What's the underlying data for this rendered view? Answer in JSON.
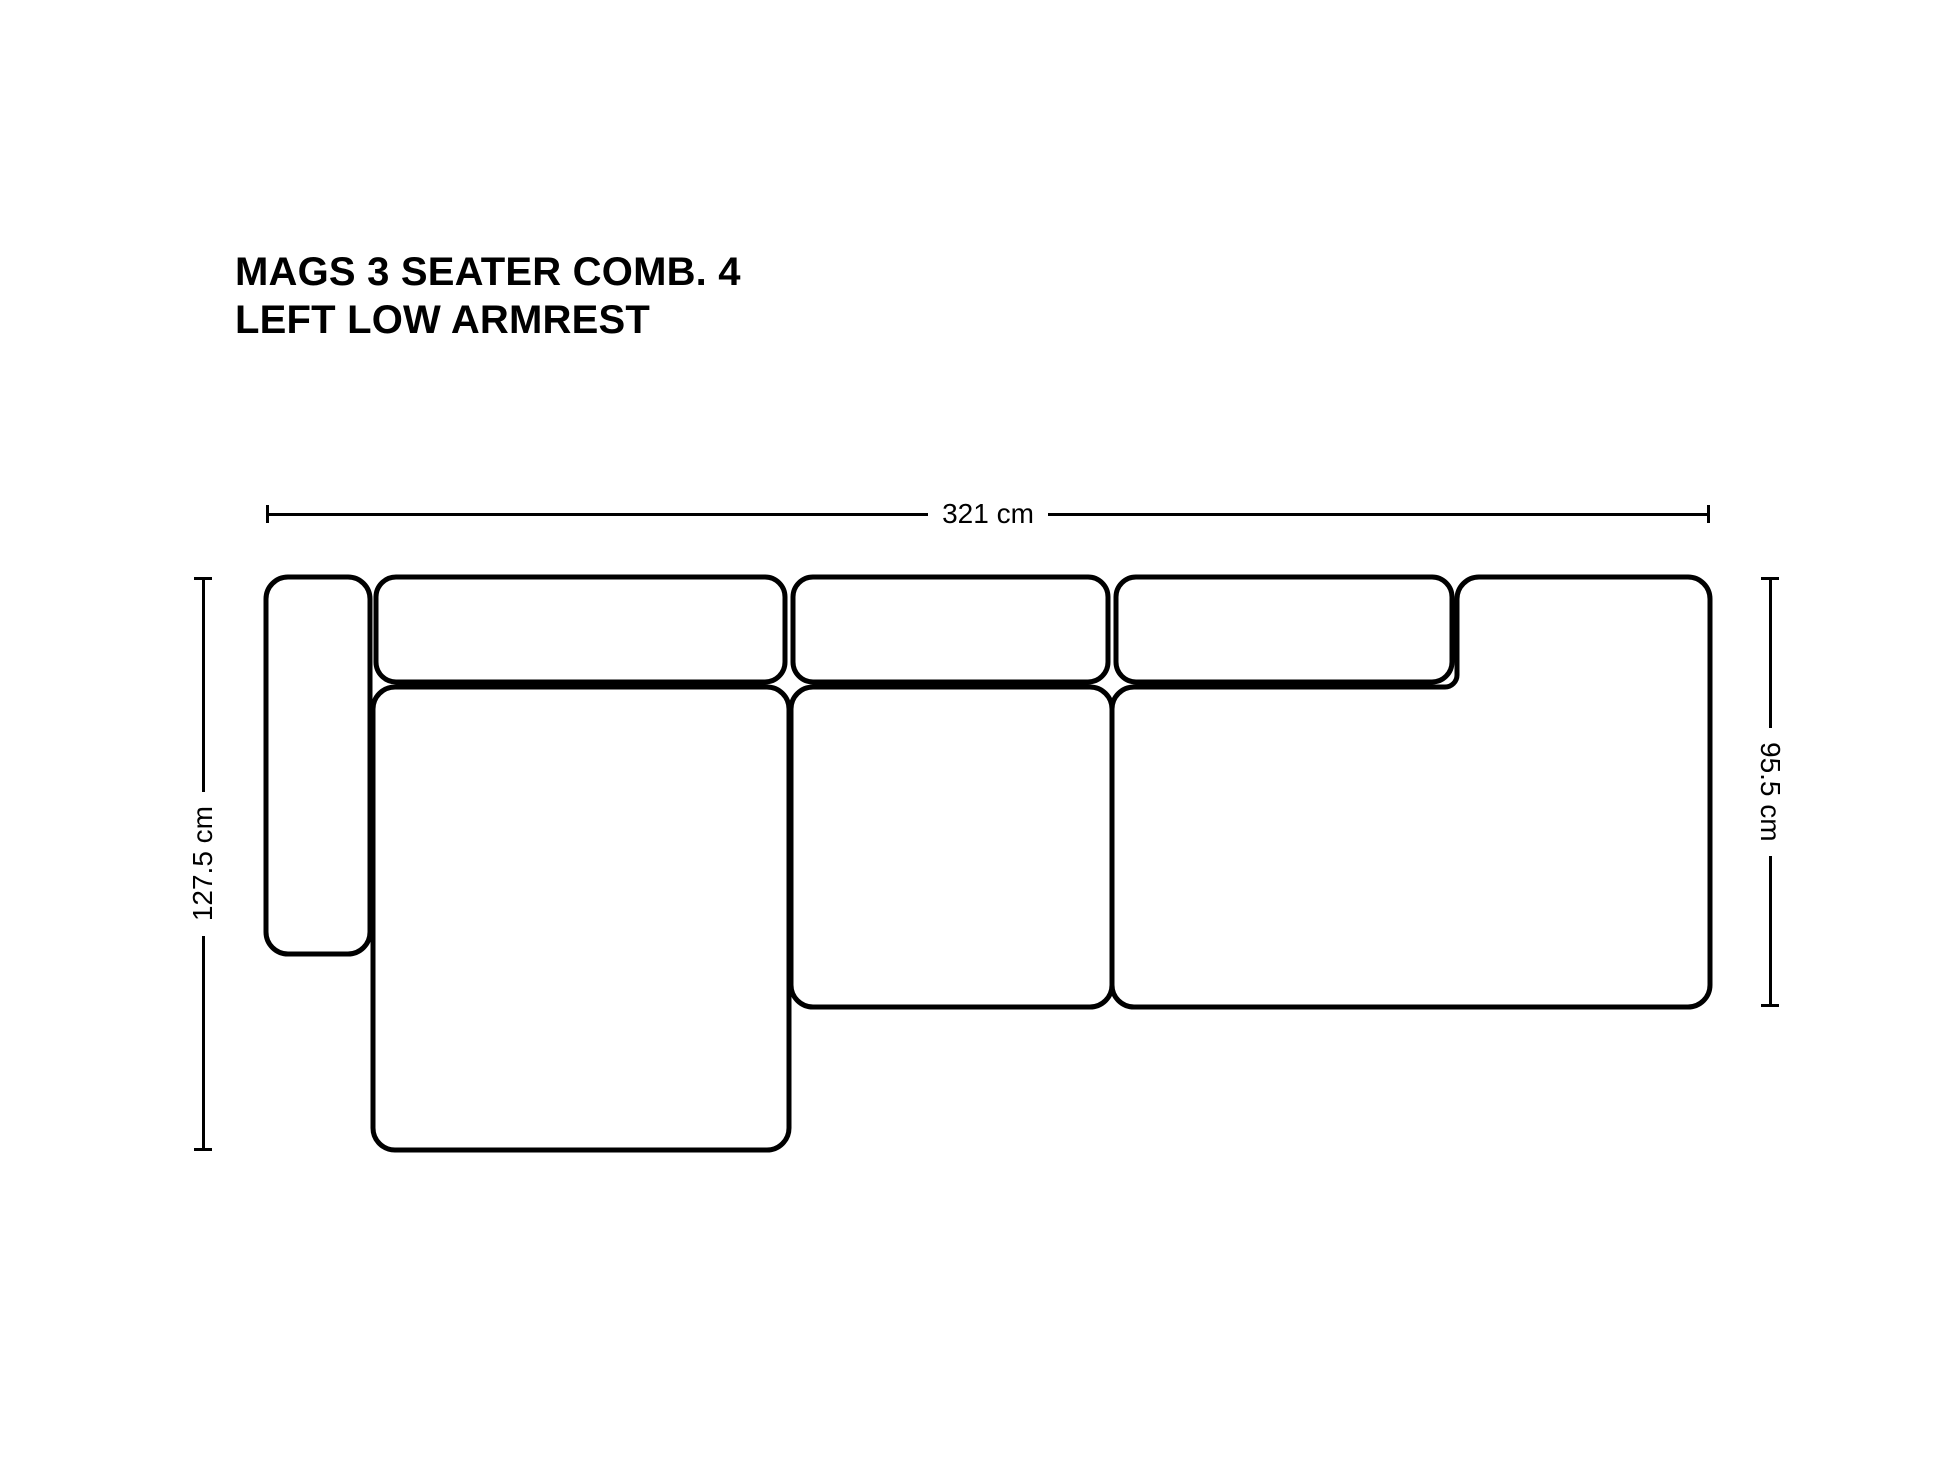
{
  "title": {
    "line1": "MAGS 3 SEATER COMB. 4",
    "line2": "LEFT LOW ARMREST"
  },
  "dimensions": {
    "width_label": "321 cm",
    "total_depth_label": "127.5 cm",
    "right_depth_label": "95.5 cm"
  },
  "colors": {
    "line": "#000000",
    "background": "#ffffff"
  }
}
